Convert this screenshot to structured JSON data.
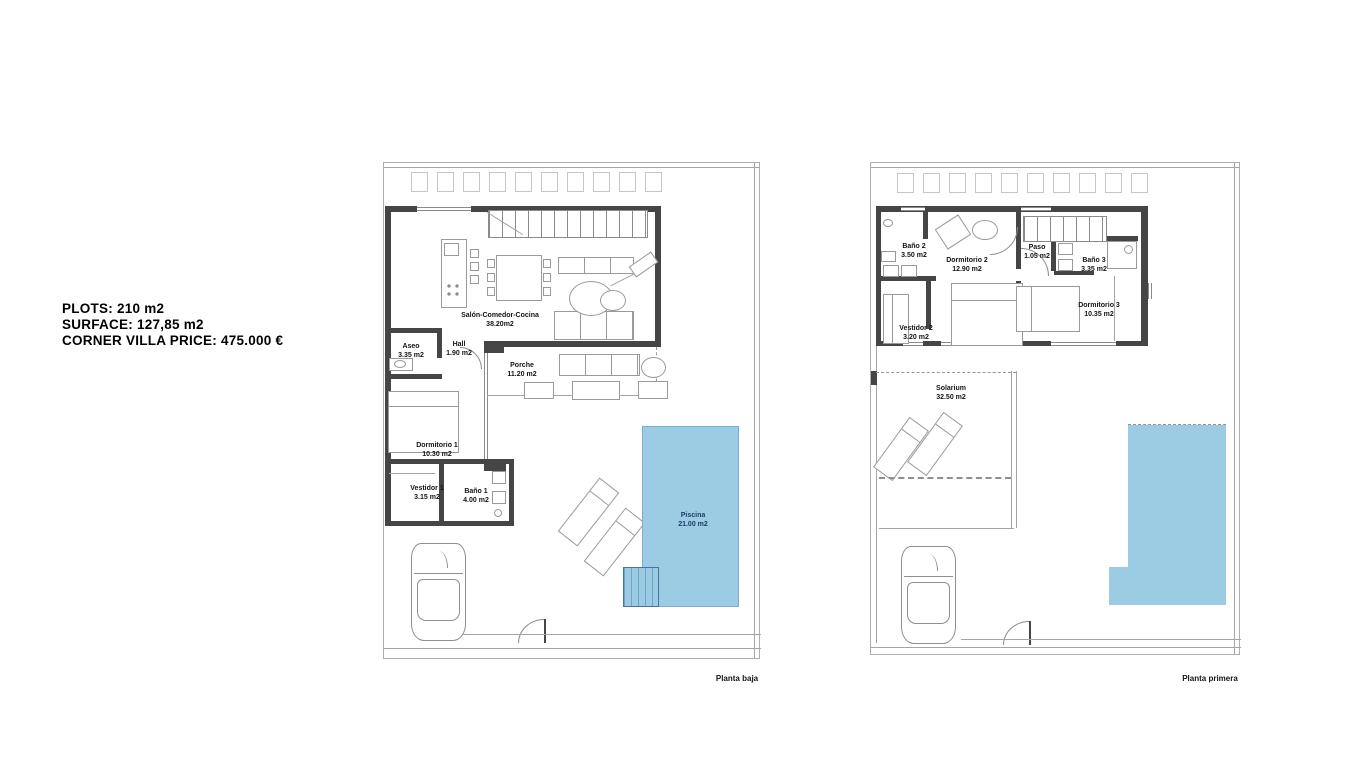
{
  "info_panel": {
    "line1": "PLOTS: 210 m2",
    "line2": "SURFACE: 127,85 m2",
    "line3": "CORNER VILLA PRICE: 475.000 €"
  },
  "plans": [
    {
      "caption": "Planta baja",
      "rooms": [
        {
          "name": "Aseo",
          "area": "3.35 m2"
        },
        {
          "name": "Hall",
          "area": "1.90 m2"
        },
        {
          "name": "Salón-Comedor-Cocina",
          "area": "38.20m2"
        },
        {
          "name": "Porche",
          "area": "11.20 m2"
        },
        {
          "name": "Dormitorio 1",
          "area": "10.30 m2"
        },
        {
          "name": "Vestidor 1",
          "area": "3.15 m2"
        },
        {
          "name": "Baño 1",
          "area": "4.00 m2"
        },
        {
          "name": "Piscina",
          "area": "21.00 m2"
        }
      ]
    },
    {
      "caption": "Planta primera",
      "rooms": [
        {
          "name": "Baño 2",
          "area": "3.50 m2"
        },
        {
          "name": "Dormitorio 2",
          "area": "12.90 m2"
        },
        {
          "name": "Paso",
          "area": "1.05 m2"
        },
        {
          "name": "Baño 3",
          "area": "3.35 m2"
        },
        {
          "name": "Dormitorio 3",
          "area": "10.35 m2"
        },
        {
          "name": "Vestidor 2",
          "area": "3.20 m2"
        },
        {
          "name": "Solarium",
          "area": "32.50 m2"
        }
      ]
    }
  ],
  "colors": {
    "pool_fill": "#9ccbe4",
    "pool_text": "#1f3b66",
    "wall": "#454545",
    "plot_line": "#adadad"
  }
}
